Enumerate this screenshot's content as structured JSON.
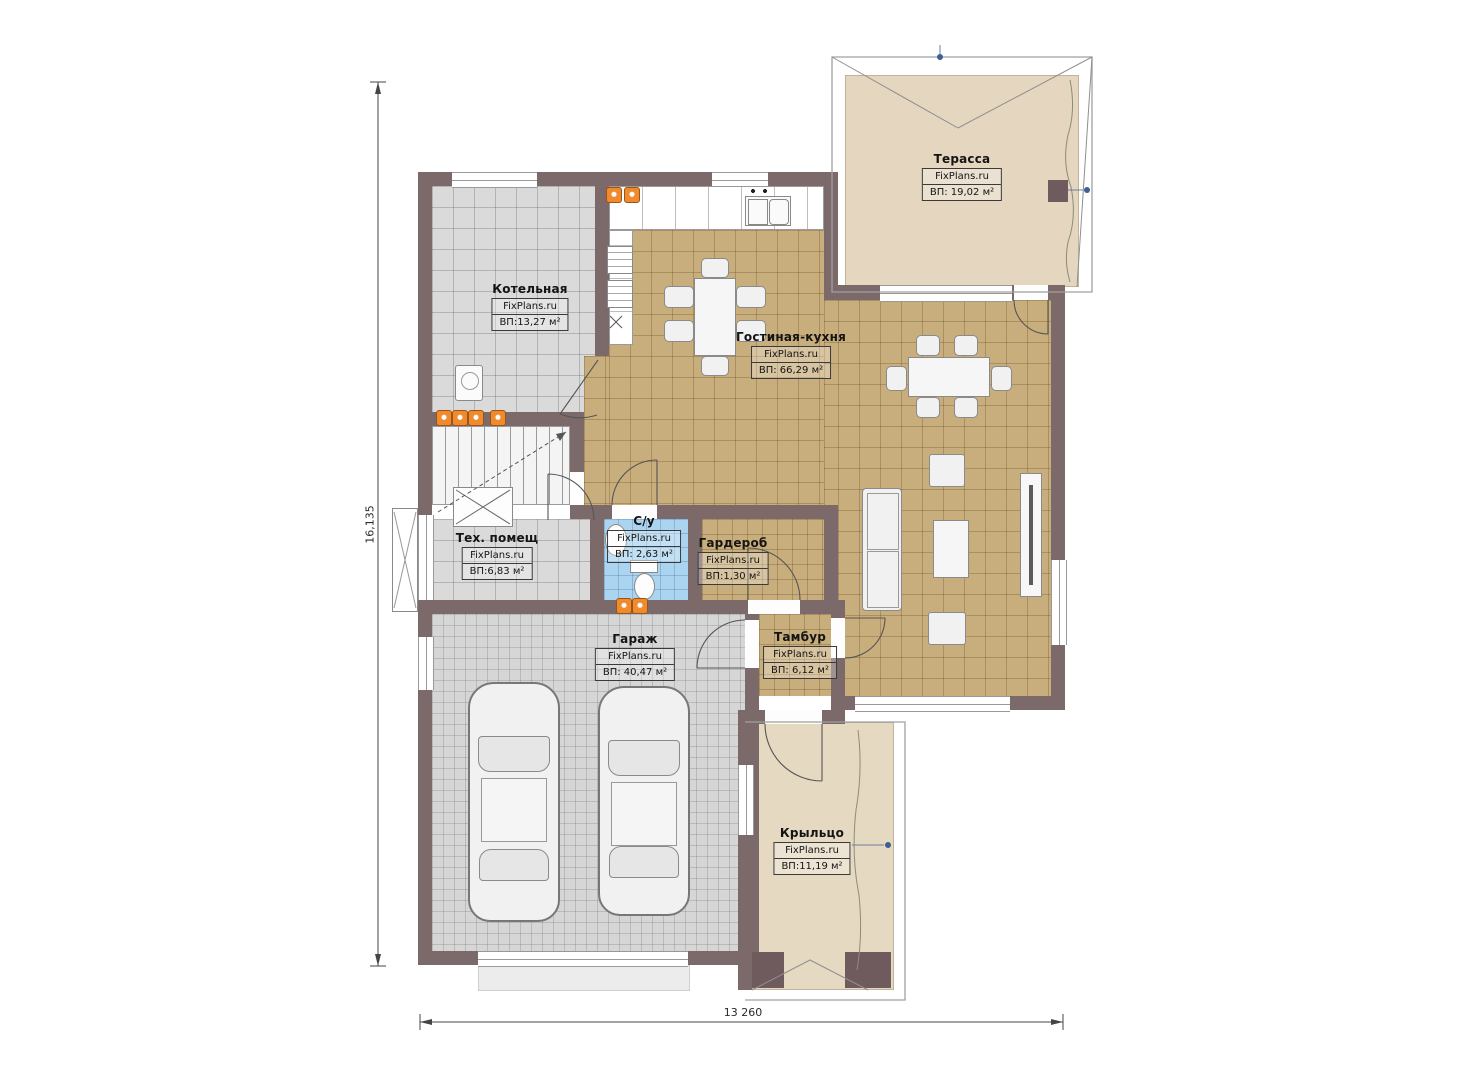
{
  "plan": {
    "watermark": "FixPlans.ru",
    "rooms": [
      {
        "id": "terrace",
        "name": "Терасса",
        "area": "ВП: 19,02 м²"
      },
      {
        "id": "boiler",
        "name": "Котельная",
        "area": "ВП:13,27 м²"
      },
      {
        "id": "living_kitchen",
        "name": "Гостиная-кухня",
        "area": "ВП: 66,29 м²"
      },
      {
        "id": "tech",
        "name": "Тех. помещ",
        "area": "ВП:6,83 м²"
      },
      {
        "id": "bathroom",
        "name": "С/у",
        "area": "ВП: 2,63 м²"
      },
      {
        "id": "wardrobe",
        "name": "Гардероб",
        "area": "ВП:1,30 м²"
      },
      {
        "id": "garage",
        "name": "Гараж",
        "area": "ВП: 40,47 м²"
      },
      {
        "id": "vestibule",
        "name": "Тамбур",
        "area": "ВП: 6,12 м²"
      },
      {
        "id": "porch",
        "name": "Крыльцо",
        "area": "ВП:11,19 м²"
      }
    ],
    "dimensions": {
      "vertical": "16,135",
      "horizontal": "13 260"
    },
    "colors": {
      "wall": "#7c696a",
      "wall_dark": "#6f5b5d",
      "floor_living": "#c9ae7d",
      "floor_service": "#dadada",
      "floor_garage": "#d6d6d6",
      "floor_bath": "#abd4f0",
      "floor_terrace": "#e4d6bf",
      "floor_porch": "#e6d9c2",
      "radiator": "#f08a2e",
      "dim_marker": "#3d5f93"
    }
  }
}
